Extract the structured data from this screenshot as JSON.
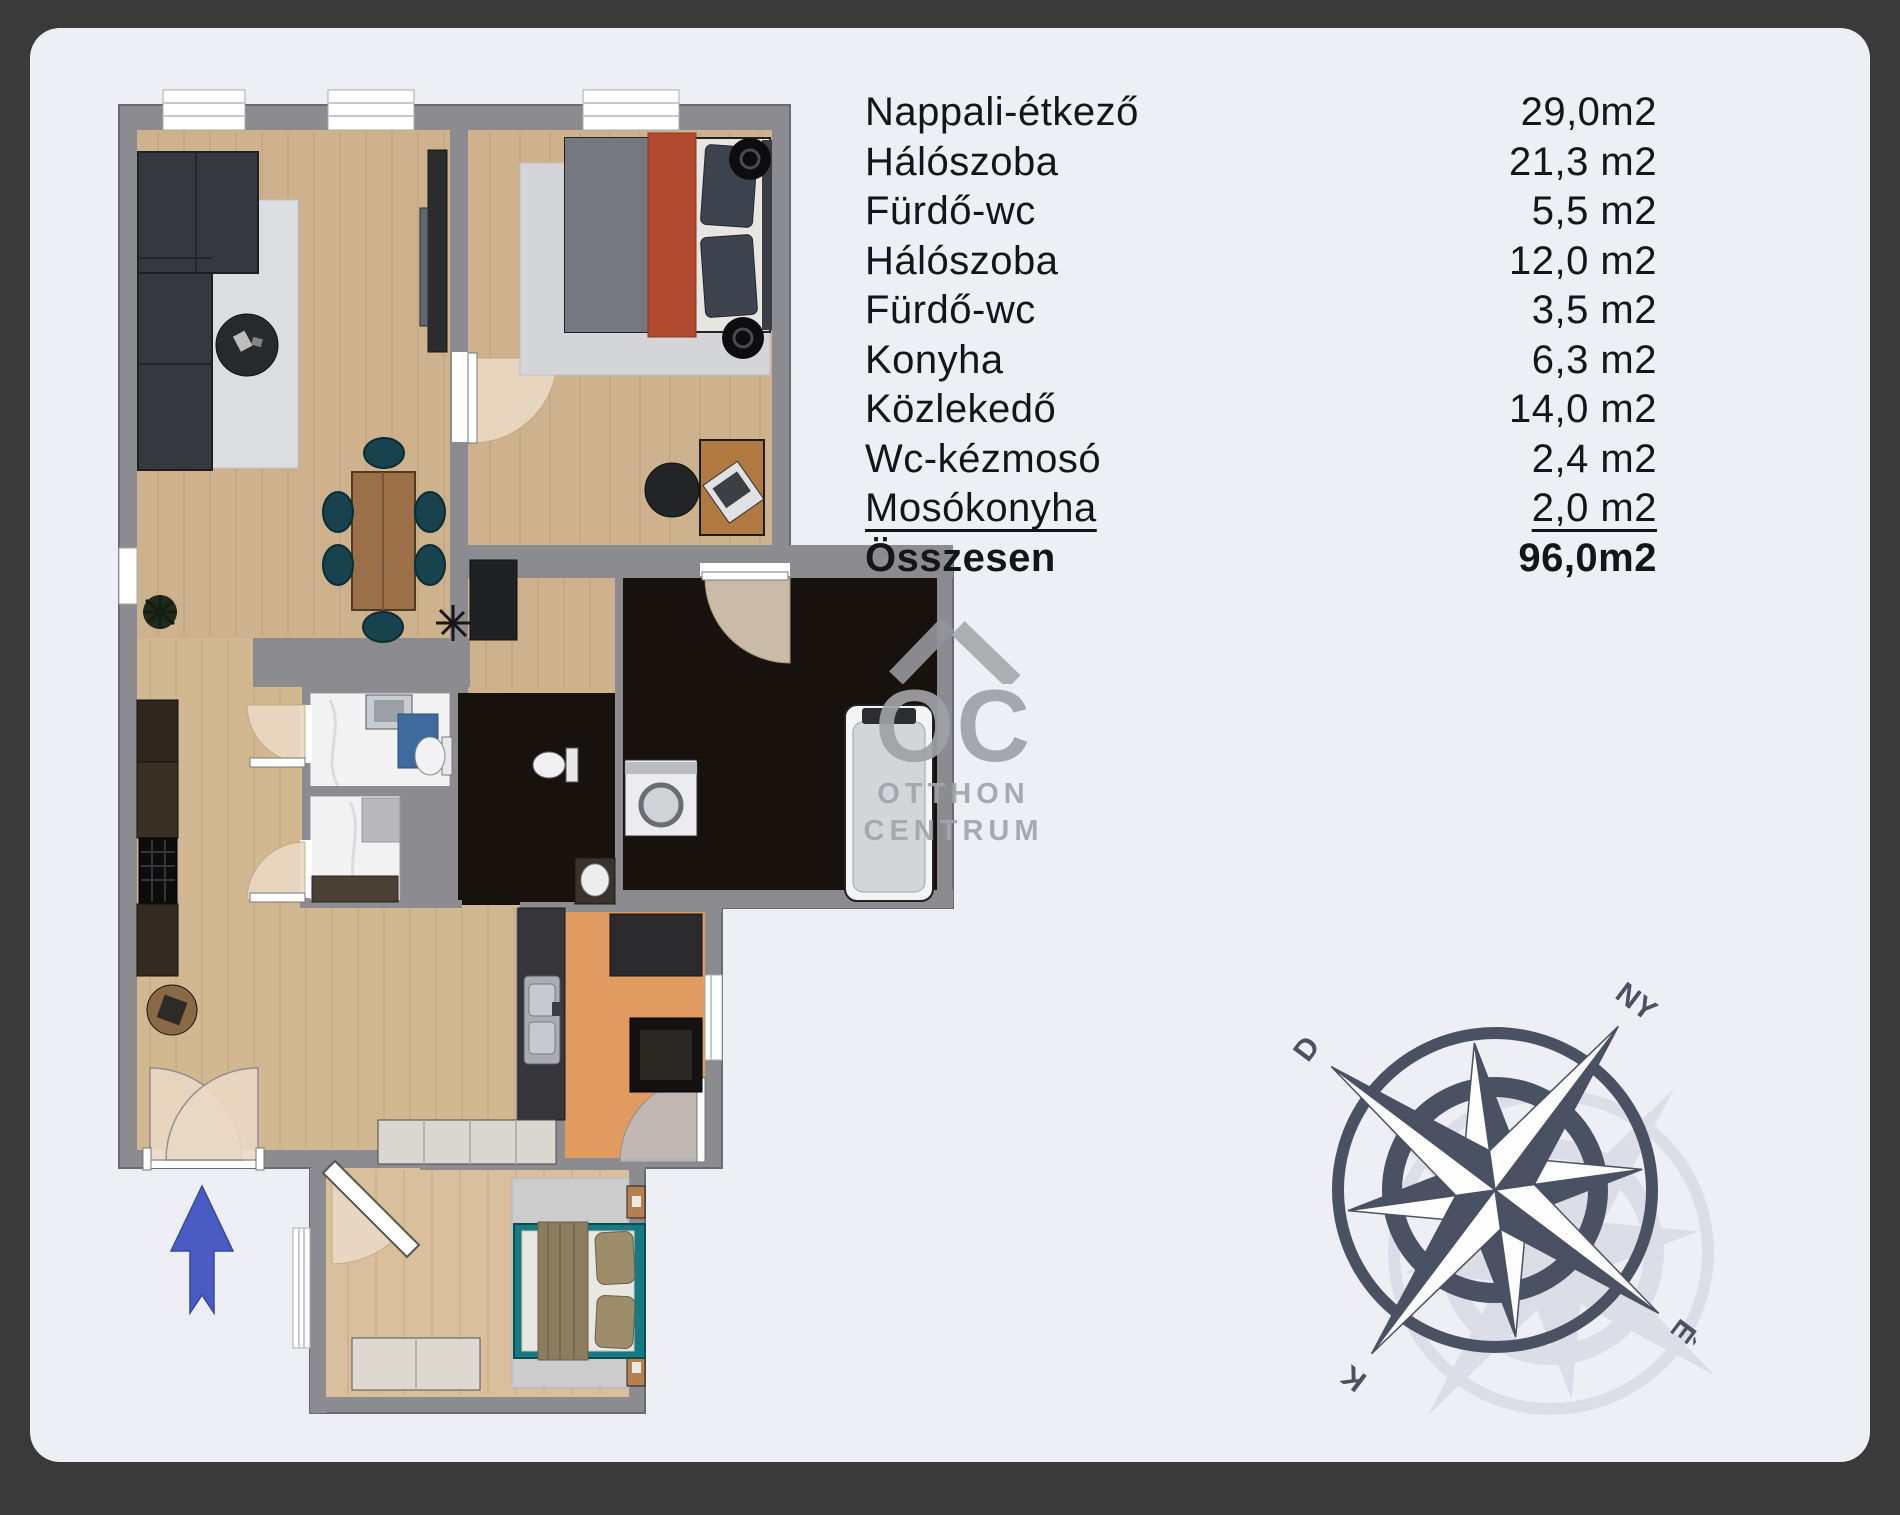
{
  "room_list": {
    "rooms": [
      {
        "name": "Nappali-étkező",
        "area": "29,0m2"
      },
      {
        "name": "Hálószoba",
        "area": "21,3 m2"
      },
      {
        "name": "Fürdő-wc",
        "area": "5,5 m2"
      },
      {
        "name": "Hálószoba",
        "area": "12,0 m2"
      },
      {
        "name": "Fürdő-wc",
        "area": "3,5 m2"
      },
      {
        "name": "Konyha",
        "area": "6,3 m2"
      },
      {
        "name": "Közlekedő",
        "area": "14,0 m2"
      },
      {
        "name": "Wc-kézmosó",
        "area": "2,4 m2"
      },
      {
        "name": "Mosókonyha",
        "area": "2,0 m2"
      }
    ],
    "total": {
      "name": "Összesen",
      "area": "96,0m2"
    }
  },
  "watermark": {
    "monogram": "OC",
    "line1": "OTTHON",
    "line2": "CENTRUM"
  },
  "compass": {
    "north": "É",
    "south": "D",
    "east": "K",
    "west": "NY"
  },
  "colors": {
    "page_background": "#3a3a3b",
    "panel": "#edeff5",
    "wall_gray": "#8b8b90",
    "wood_floor": "#cdb28d",
    "kitchen_orange": "#e19a60",
    "bathroom_black": "#18120f",
    "bed_teal": "#157a82",
    "rust_blanket": "#b14a2e",
    "entry_arrow_blue": "#4a5cc4",
    "compass_slate": "#4a5163",
    "watermark_gray": "#a0a1a6"
  }
}
